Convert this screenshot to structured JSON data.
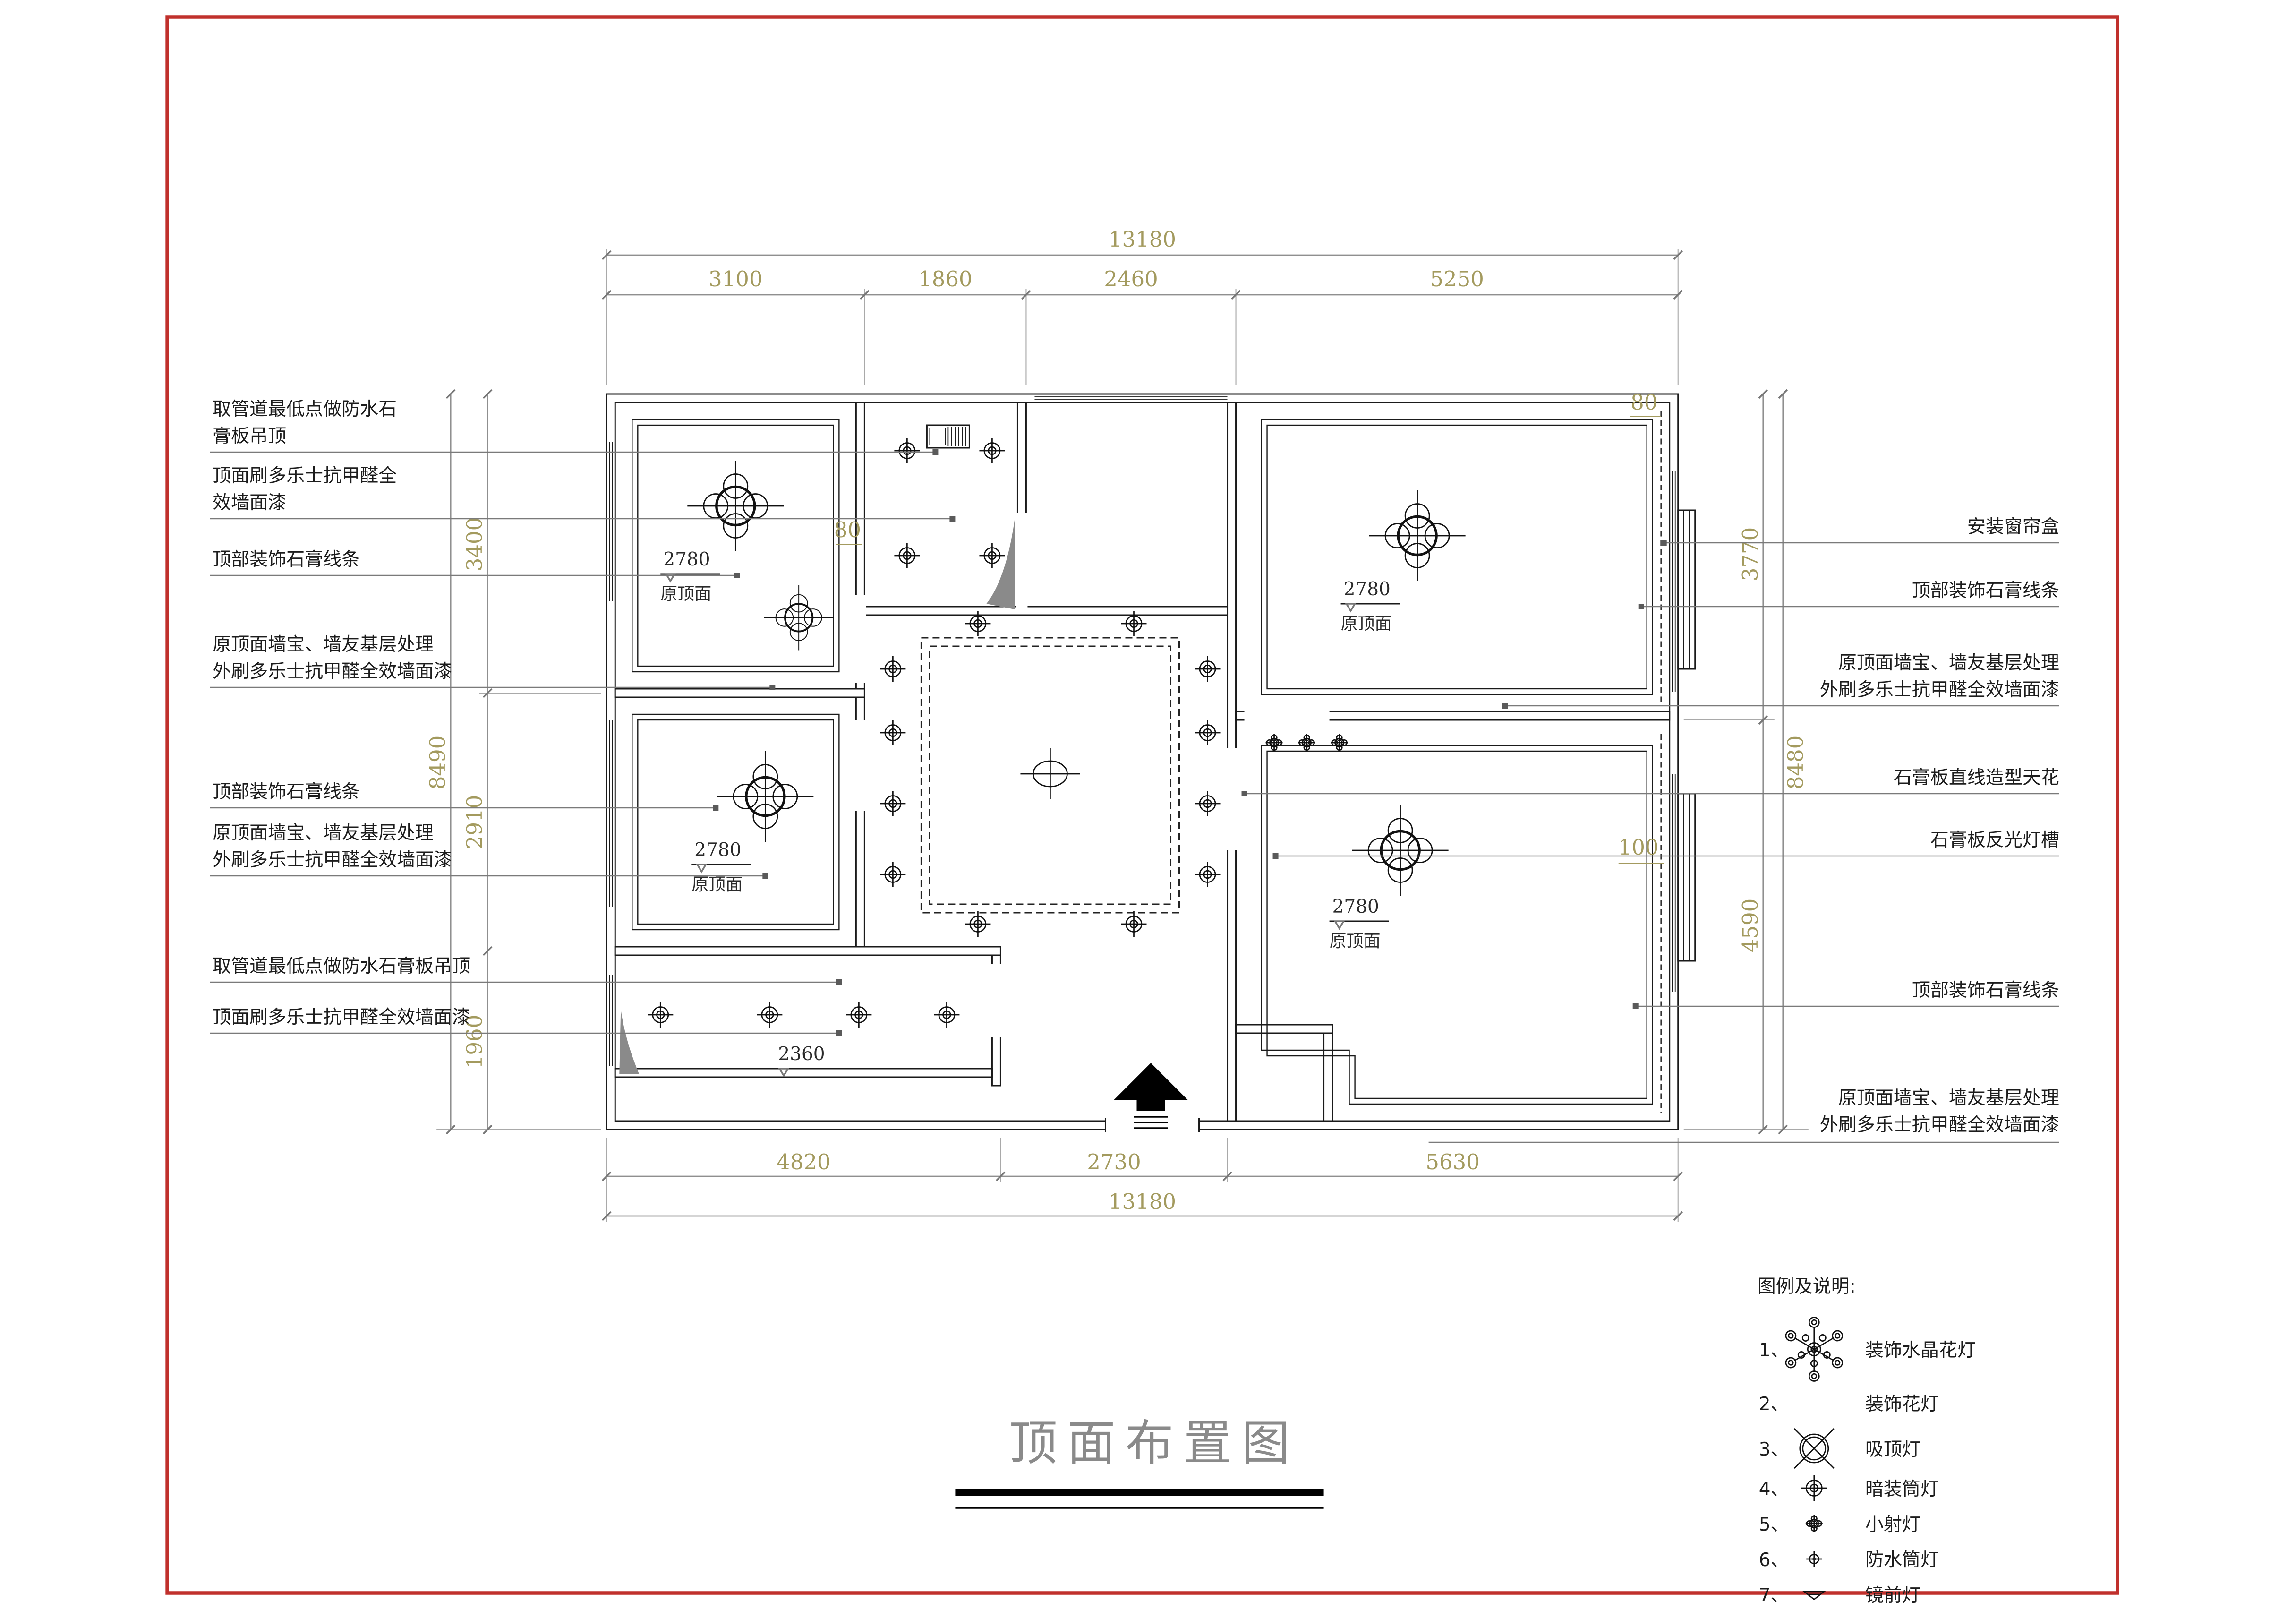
{
  "colors": {
    "sheet_border": "#c0302c",
    "dim_text": "#a39a5e",
    "title_gray": "#8a8a8a"
  },
  "title": {
    "text": "顶面布置图"
  },
  "plan": {
    "dims": {
      "top_overall": "13180",
      "top_segments": [
        "3100",
        "1860",
        "2460",
        "5250"
      ],
      "bottom_segments": [
        "4820",
        "2730",
        "5630"
      ],
      "bottom_overall": "13180",
      "left_segments": [
        "3400",
        "2910",
        "1960"
      ],
      "left_overall": "8490",
      "right_segments": [
        "3770",
        "4590"
      ],
      "right_overall": "8480",
      "offset_a": "80",
      "offset_b": "80",
      "offset_c": "100"
    },
    "levels": {
      "h2780": "2780",
      "ref": "原顶面",
      "h2360": "2360"
    }
  },
  "callouts": {
    "left": [
      {
        "lines": [
          "取管道最低点做防水石",
          "膏板吊顶"
        ]
      },
      {
        "lines": [
          "顶面刷多乐士抗甲醛全",
          "效墙面漆"
        ]
      },
      {
        "lines": [
          "顶部装饰石膏线条"
        ]
      },
      {
        "lines": [
          "原顶面墙宝、墙友基层处理",
          "外刷多乐士抗甲醛全效墙面漆"
        ]
      },
      {
        "lines": [
          "顶部装饰石膏线条"
        ]
      },
      {
        "lines": [
          "原顶面墙宝、墙友基层处理",
          "外刷多乐士抗甲醛全效墙面漆"
        ]
      },
      {
        "lines": [
          "取管道最低点做防水石膏板吊顶"
        ]
      },
      {
        "lines": [
          "顶面刷多乐士抗甲醛全效墙面漆"
        ]
      }
    ],
    "right": [
      {
        "lines": [
          "安装窗帘盒"
        ]
      },
      {
        "lines": [
          "顶部装饰石膏线条"
        ]
      },
      {
        "lines": [
          "原顶面墙宝、墙友基层处理",
          "外刷多乐士抗甲醛全效墙面漆"
        ]
      },
      {
        "lines": [
          "石膏板直线造型天花"
        ]
      },
      {
        "lines": [
          "石膏板反光灯槽"
        ]
      },
      {
        "lines": [
          "顶部装饰石膏线条"
        ]
      },
      {
        "lines": [
          "原顶面墙宝、墙友基层处理",
          "外刷多乐士抗甲醛全效墙面漆"
        ]
      }
    ]
  },
  "legend": {
    "heading": "图例及说明:",
    "items": [
      {
        "no": "1、",
        "label": "装饰水晶花灯",
        "symbol": "crystal-chandelier-icon"
      },
      {
        "no": "2、",
        "label": "装饰花灯",
        "symbol": "flower-lamp-icon"
      },
      {
        "no": "3、",
        "label": "吸顶灯",
        "symbol": "ceiling-lamp-icon"
      },
      {
        "no": "4、",
        "label": "暗装筒灯",
        "symbol": "recessed-downlight-icon"
      },
      {
        "no": "5、",
        "label": "小射灯",
        "symbol": "small-spotlight-icon"
      },
      {
        "no": "6、",
        "label": "防水筒灯",
        "symbol": "waterproof-downlight-icon"
      },
      {
        "no": "7、",
        "label": "镜前灯",
        "symbol": "mirror-light-icon"
      }
    ]
  }
}
